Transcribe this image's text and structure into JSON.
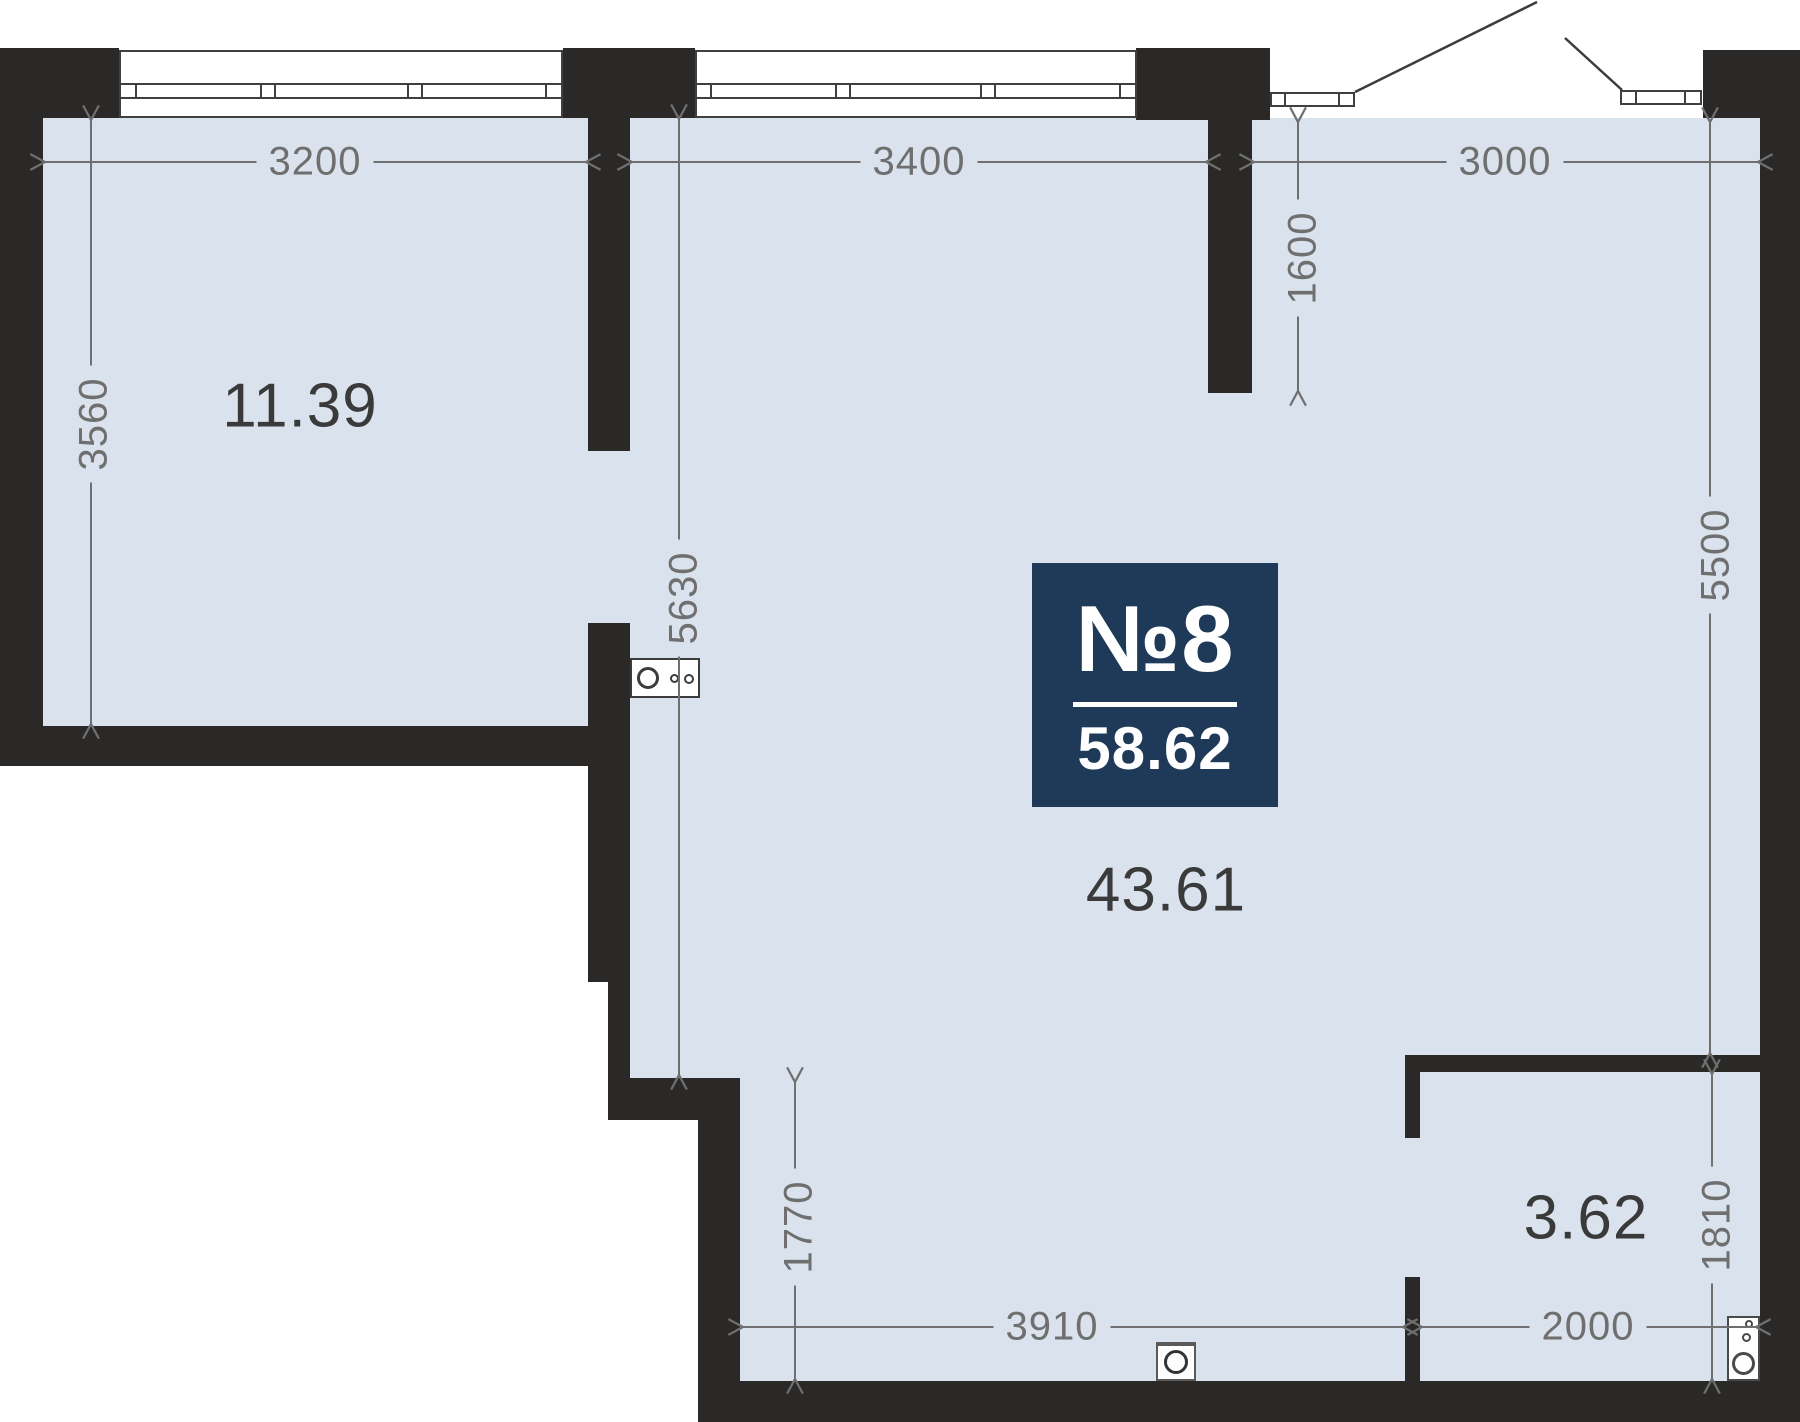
{
  "badge": {
    "number": "№8",
    "total_area": "58.62"
  },
  "rooms": [
    {
      "name": "room",
      "area": "11.39"
    },
    {
      "name": "living-kitchen",
      "area": "43.61"
    },
    {
      "name": "bathroom",
      "area": "3.62"
    }
  ],
  "dims": {
    "room1_width": "3200",
    "living_width": "3400",
    "hall_width": "3000",
    "room1_depth": "3560",
    "living_depth": "5630",
    "entry_depth": "1600",
    "right_depth": "5500",
    "lower_left_depth": "1770",
    "bath_depth": "1810",
    "bottom_width": "3910",
    "bath_width": "2000"
  },
  "fixtures": [
    {
      "name": "kitchen-sink"
    },
    {
      "name": "washing-machine"
    },
    {
      "name": "washbasin"
    }
  ],
  "colors": {
    "floor": "#d9e2ed",
    "wall": "#2a2928",
    "badge_bg": "#1f3a58",
    "dim_text": "#6f6f6f",
    "area_text": "#3a3a3a",
    "fixture_line": "#3f3f3f"
  }
}
